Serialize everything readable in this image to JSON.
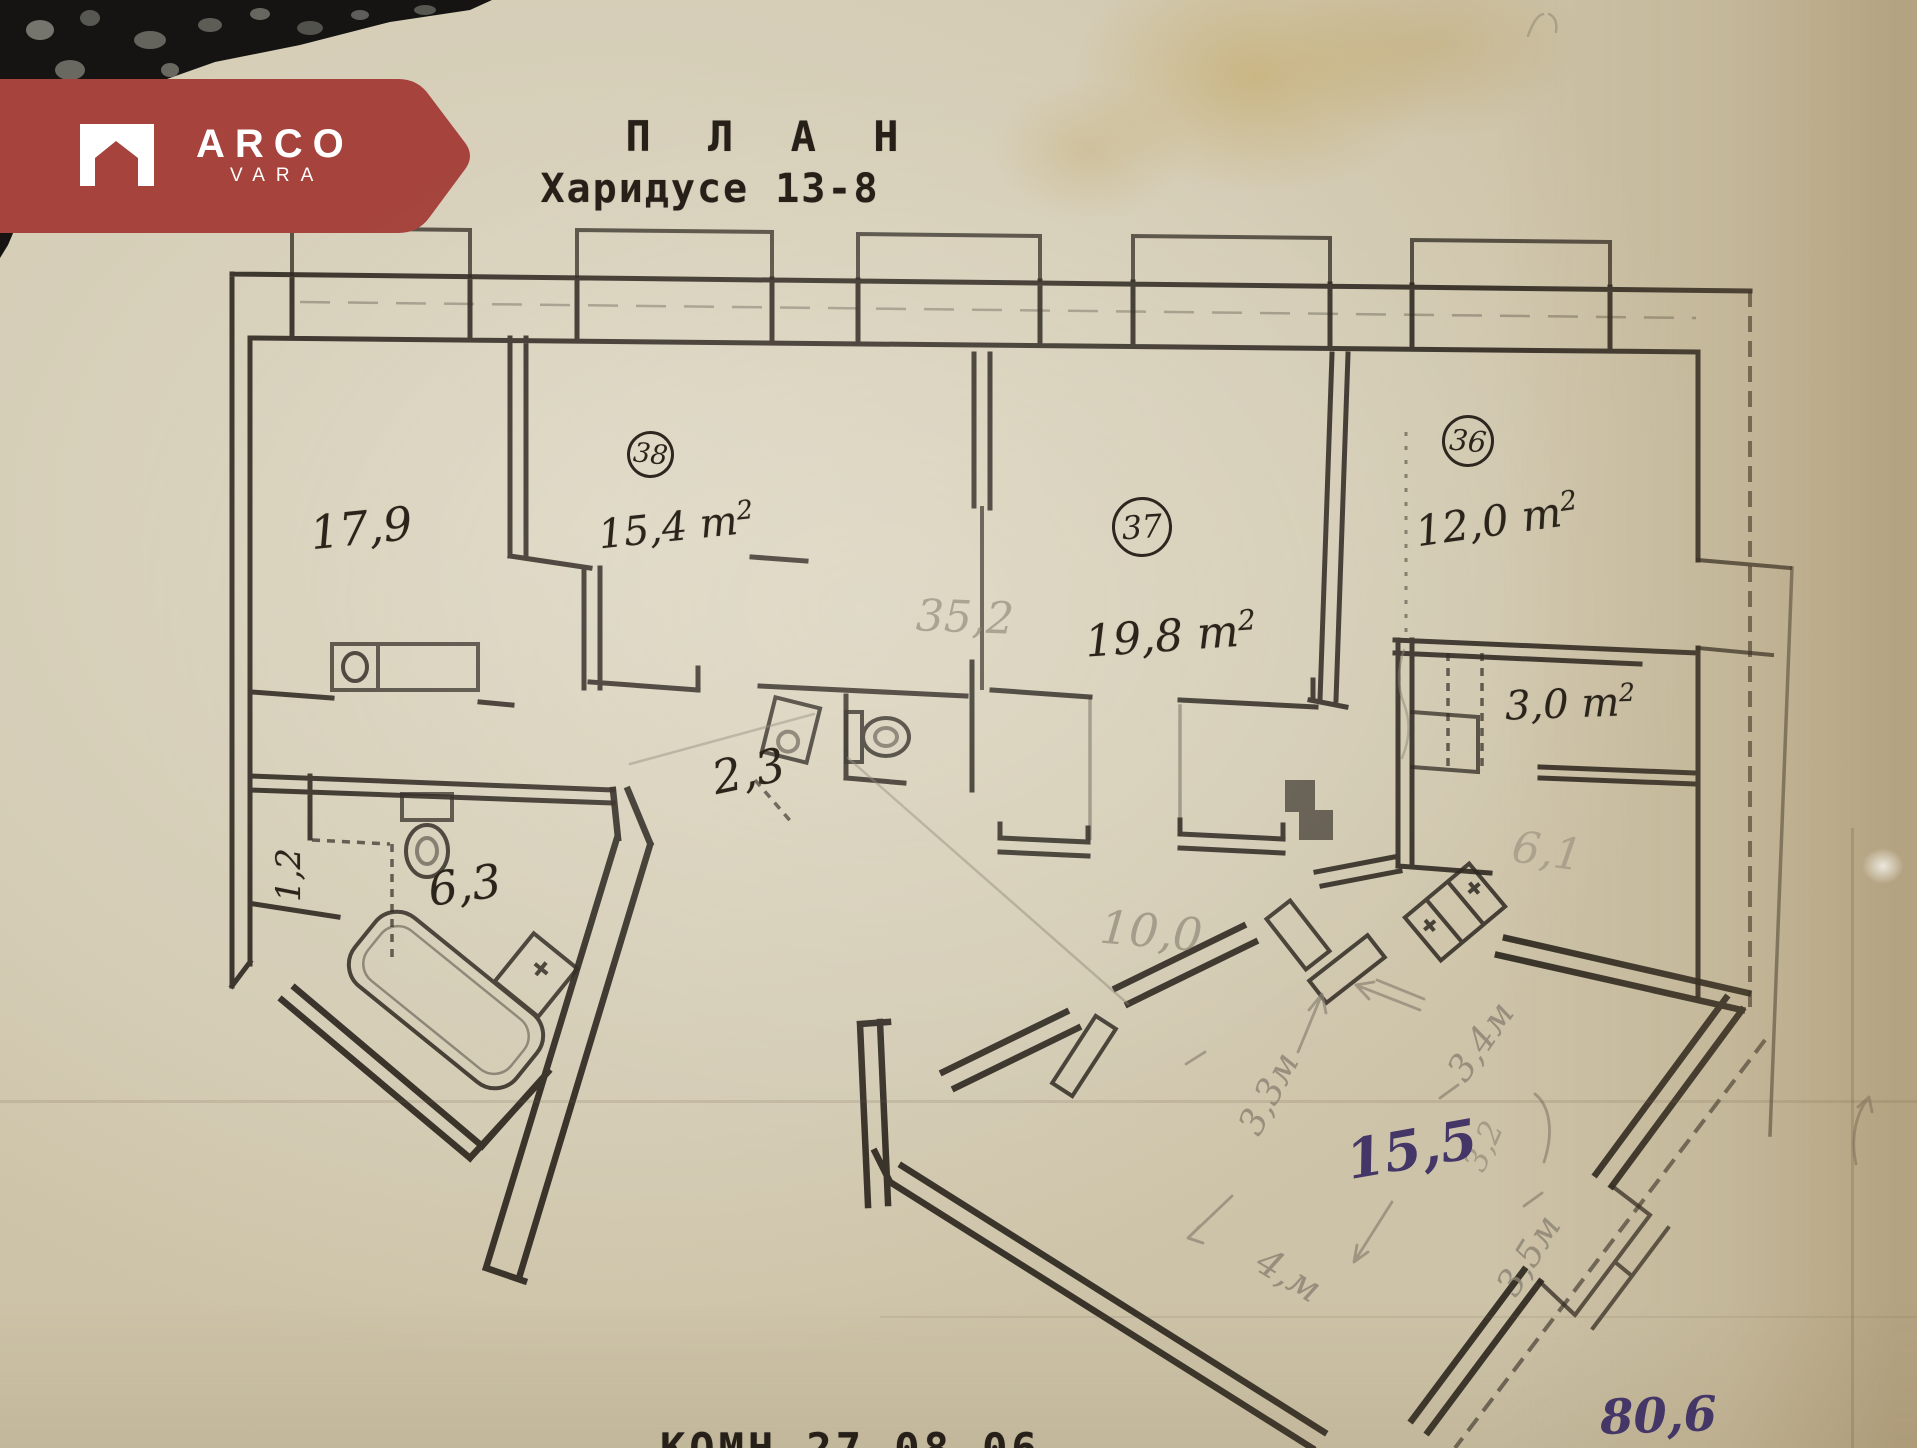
{
  "logo": {
    "brand": "ARCO",
    "sub": "VARA"
  },
  "title": {
    "line1": "П Л А Н",
    "line2": "Харидусе 13-8"
  },
  "sup2": "2",
  "rooms": {
    "n38": "38",
    "n37": "37",
    "n36": "36",
    "a17_9": "17,9",
    "a38": "15,4 m",
    "a37": "19,8 m",
    "a36": "12,0 m",
    "a3_0": "3,0 m",
    "bath": "6,3",
    "hall": "2,3",
    "niche": "1,2"
  },
  "pencil": {
    "p35_2": "35,2",
    "p10_0": "10,0",
    "p6_1": "6,1",
    "d3_3": "3,3м",
    "d3_4": "3,4м",
    "d3_2": "3,2",
    "d4": "4,м",
    "d3_5": "3,5м"
  },
  "purple": {
    "room15_5": "15,5",
    "total": "80,6"
  },
  "footer": {
    "text": "КОМН  27 08 06"
  },
  "colors": {
    "banner": "#a5433c",
    "ink": "#2d2720",
    "pencil": "#8a8172",
    "purple": "#443767",
    "paper": "#d6cfba"
  }
}
